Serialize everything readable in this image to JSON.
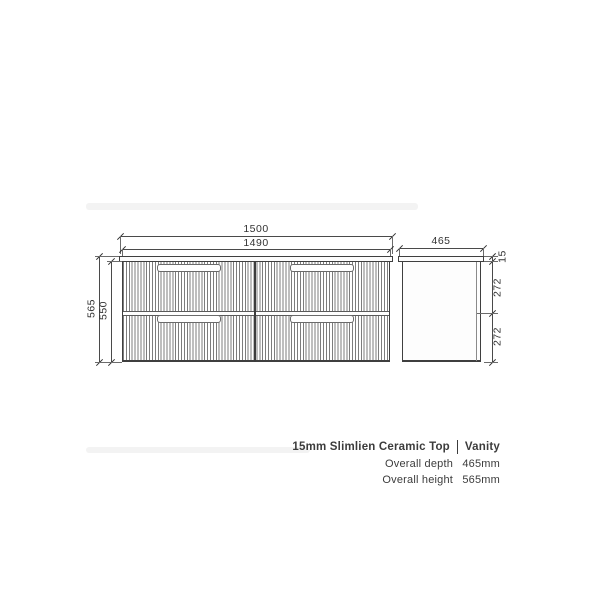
{
  "drawing": {
    "front": {
      "width_top": "1500",
      "width_inner": "1490",
      "height_overall": "565",
      "height_cabinet": "550"
    },
    "side": {
      "depth": "465",
      "top_thickness": "15",
      "upper_drawer": "272",
      "lower_drawer": "272"
    }
  },
  "spec": {
    "title_left": "15mm Slimlien Ceramic Top",
    "title_right": "Vanity",
    "depth_label": "Overall depth",
    "depth_value": "465mm",
    "height_label": "Overall height",
    "height_value": "565mm"
  },
  "colors": {
    "line": "#3f3f3f",
    "flute": "#7d7d7d",
    "text": "#3c3c3c",
    "background": "#ffffff"
  }
}
